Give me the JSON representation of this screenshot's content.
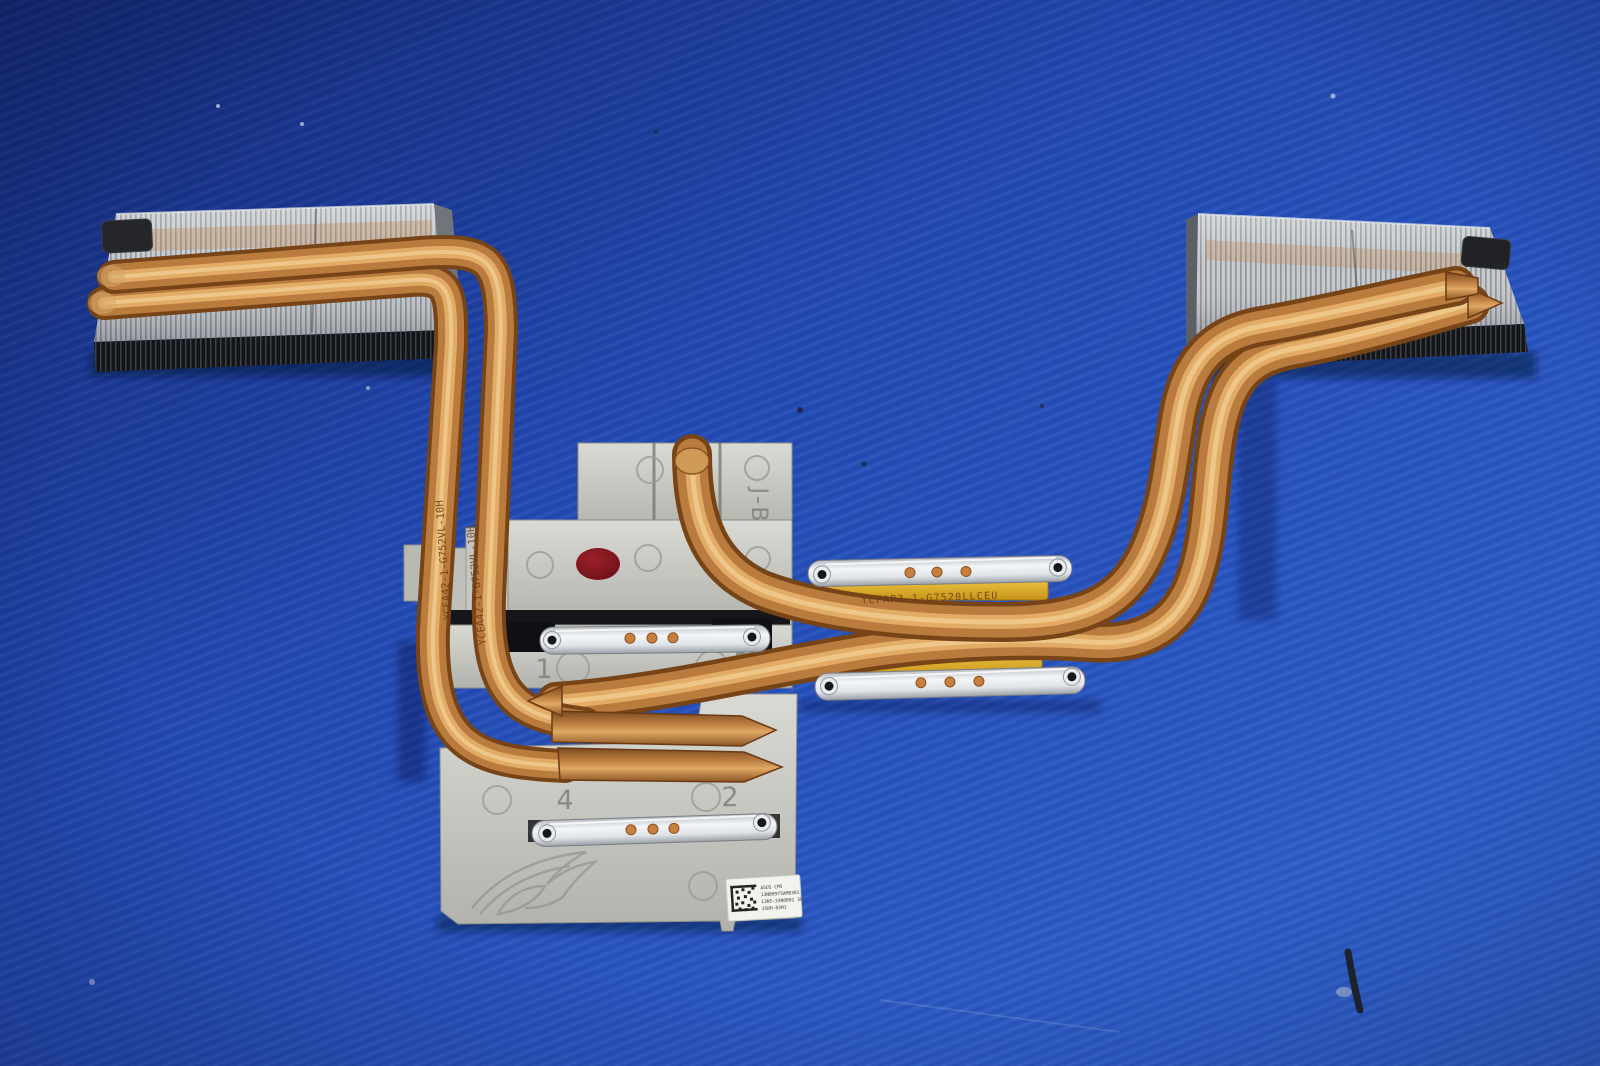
{
  "scene": {
    "subject": "laptop-heatsink-photo",
    "background_color": "#2450b6",
    "copper_color": "#b97c3e",
    "fin_color": "#c6cacd",
    "plate_color": "#c9c9c3",
    "bracket_color": "#eef0f2",
    "thermal_pad_color": "#e9b32c",
    "red_marker_color": "#7d1420"
  },
  "markings": {
    "jb_stamp": "J-B",
    "screw_1": "1",
    "screw_2": "2",
    "screw_3": "3",
    "screw_4": "4",
    "pipe_print_left": "YCEA42-1-G752VL-10H",
    "pipe_print_right": "YCFAP3-1-G7520LLCEU"
  },
  "sticker": {
    "line1": "ASUS  CM5",
    "line2": "13NB09Y5AM0301",
    "line3": "13N5-33N0B01 3A",
    "line4": "15BH-03M1"
  }
}
